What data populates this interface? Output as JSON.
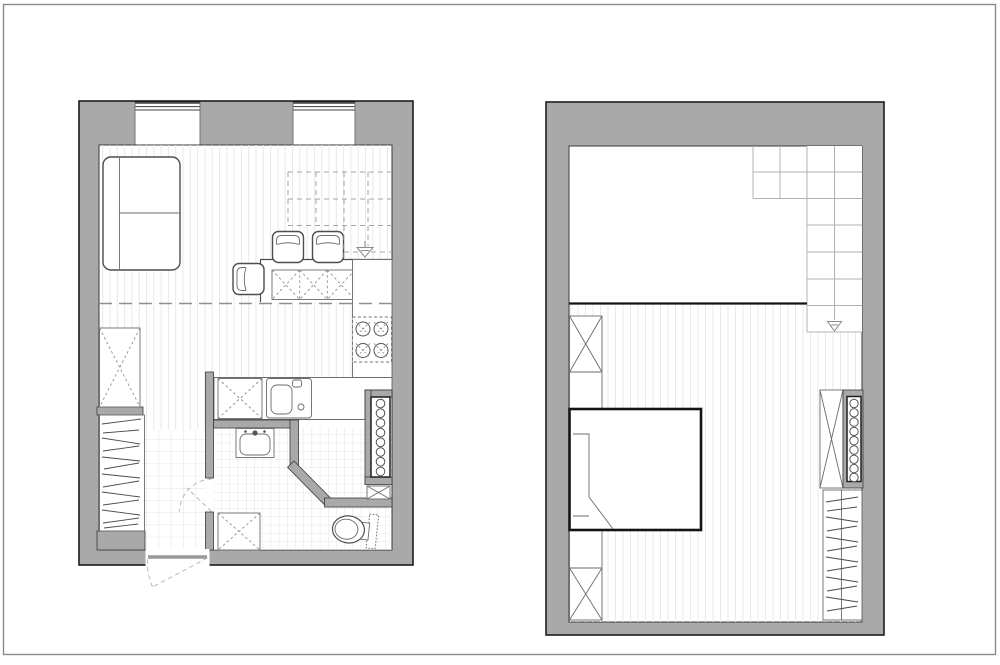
{
  "document": {
    "kind": "architectural-floor-plan",
    "views": 2,
    "has_text": false
  },
  "colors": {
    "bg": "#ffffff",
    "frame": "#8a8a8a",
    "wall": "#a9a9a9",
    "outline": "#1d1d1d",
    "furniture": "#4d4d4d",
    "dashed_overhead": "#8f8f8f",
    "stair_lines": "#b3b3b3",
    "wood_floor_lines": "#e8e8e8",
    "tile_lines": "#dcdcdc",
    "bed_outline": "#141414"
  },
  "plans": [
    {
      "name": "lower-level-plan",
      "label": "Lower level: living room with kitchen, hallway, shower room and WC",
      "windows": 2,
      "furniture": [
        "sofa",
        "dining-table",
        "dining-chair x3",
        "kitchen-island-cabinet",
        "cooktop-4-burners",
        "kitchen-sink",
        "kitchen-counter",
        "tall-cabinet-dashed",
        "wardrobe-hanging-rail",
        "radiator",
        "washbasin",
        "toilet",
        "washing-machine",
        "shower",
        "entry-door",
        "bathroom-door",
        "mezzanine-edge-dashed",
        "staircase-above-dashed"
      ]
    },
    {
      "name": "mezzanine-plan",
      "label": "Mezzanine level: sleeping area with bed, wardrobes and staircase",
      "windows": 0,
      "furniture": [
        "double-bed",
        "wardrobe x4",
        "wardrobe-hanging-rail",
        "radiator",
        "staircase",
        "void-over-lower-level"
      ]
    }
  ]
}
